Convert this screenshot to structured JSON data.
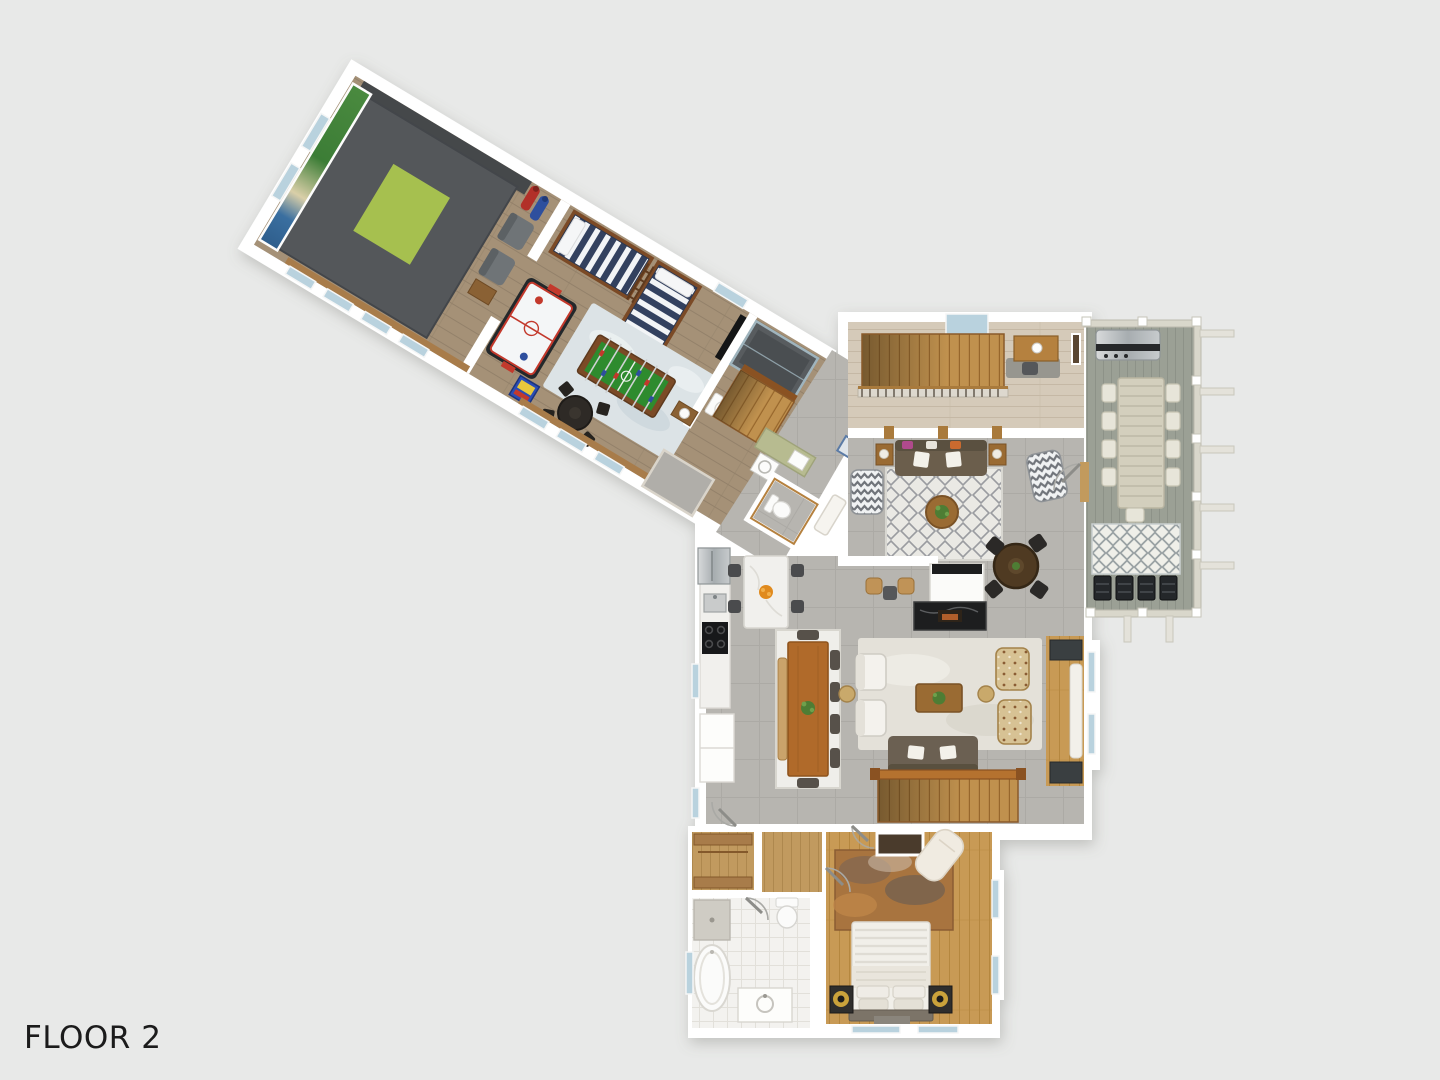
{
  "title": "Floor 2 - 3D Floor Plan",
  "floor_label": "FLOOR 2",
  "palette": {
    "background": "#e8e9e8",
    "label_color": "#1b1b1b",
    "wall": "#ffffff",
    "wood_wing": "#a59177",
    "wood_loft": "#d5cab9",
    "wood_bedroom": "#c89a55",
    "wood_hall": "#c19a5f",
    "wood_accent": "#b5813f",
    "tile_gray": "#b7b5b0",
    "tile_bath": "#f3f2ef",
    "deck_gray": "#9ba095",
    "golf_platform": "#54575a",
    "golf_mat": "#a6c04f",
    "golf_screen_green": "#3f7d3a",
    "bunk_navy": "#33415f",
    "bunk_wood": "#7b4a26",
    "air_hockey_white": "#f4f6f7",
    "accent_red": "#c3392c",
    "foosball_green": "#2e8b2e",
    "rug_blue": "#dce3e6",
    "rug_cream": "#e9e8e3",
    "rug_living": "#e4e1d9",
    "rug_outdoor": "#efefe9",
    "rug_rust": "#b06a35",
    "sofa_brown": "#6b5e4c",
    "table_wood": "#b06a2a",
    "chair_dark": "#3c3a37",
    "stool_tan": "#c09357",
    "marble_white": "#f1f0ed",
    "fireplace_black": "#1d1e1f",
    "steel_gray": "#b9bdbf",
    "bed_white": "#f1efe9",
    "lamp_gold": "#caa23b",
    "stair_wood": "#c0914e",
    "railing_wood": "#b5722f",
    "window_glass": "#b9d2de"
  },
  "rooms": [
    {
      "name": "golf-simulator-room",
      "furniture": [
        "golf-platform",
        "hitting-mat",
        "impact-screen",
        "golf-bags",
        "armchairs",
        "side-table"
      ]
    },
    {
      "name": "game-room",
      "furniture": [
        "bunk-bed-horizontal",
        "bunk-bed-vertical",
        "bunk-ladder",
        "air-hockey-table",
        "foosball-table",
        "area-rug",
        "round-game-table",
        "game-chairs",
        "arcade-machine",
        "wall-tv"
      ]
    },
    {
      "name": "wing-bathroom",
      "furniture": [
        "walk-in-shower",
        "toilet",
        "vanity"
      ]
    },
    {
      "name": "junction-hall",
      "furniture": [
        "staircase",
        "laundry-counter",
        "laundry-sink",
        "washer",
        "floor-hatch",
        "mud-rug",
        "console-table"
      ]
    },
    {
      "name": "powder-room",
      "furniture": [
        "toilet"
      ]
    },
    {
      "name": "loft-landing",
      "furniture": [
        "staircase",
        "stair-railing",
        "desk",
        "coffee-mug",
        "desk-rug",
        "skylight-window",
        "wall-art"
      ]
    },
    {
      "name": "upper-living-room",
      "furniture": [
        "sofa",
        "throw-pillows",
        "end-tables",
        "chevron-armchairs",
        "trellis-rug",
        "round-coffee-table",
        "round-game-table",
        "black-chairs",
        "media-cabinet",
        "fireplace",
        "bar-stools"
      ]
    },
    {
      "name": "kitchen",
      "furniture": [
        "refrigerator",
        "counter",
        "sink",
        "cooktop",
        "pantry-cabinets",
        "island",
        "island-stools",
        "fruit-bowl"
      ]
    },
    {
      "name": "dining-area",
      "furniture": [
        "dining-table",
        "bench",
        "dining-chairs",
        "white-rug",
        "plant-centerpiece"
      ]
    },
    {
      "name": "lower-living-room",
      "furniture": [
        "sofa",
        "white-armchairs",
        "floral-armchairs",
        "coffee-table",
        "light-rug",
        "round-side-tables",
        "window-bench",
        "main-staircase"
      ]
    },
    {
      "name": "deck",
      "furniture": [
        "grill",
        "outdoor-dining-table",
        "outdoor-chairs",
        "diamond-outdoor-rug",
        "black-lounge-chairs",
        "railing",
        "pergola-beams"
      ]
    },
    {
      "name": "master-bedroom",
      "furniture": [
        "bed",
        "striped-duvet",
        "pillows",
        "headboard",
        "nightstands",
        "gold-lamps",
        "abstract-rug",
        "chaise-lounge",
        "closet-niche"
      ]
    },
    {
      "name": "master-bathroom",
      "furniture": [
        "freestanding-tub",
        "vanity-sink",
        "toilet",
        "shower-pan"
      ]
    },
    {
      "name": "walk-in-closet",
      "furniture": [
        "shelving"
      ]
    }
  ]
}
